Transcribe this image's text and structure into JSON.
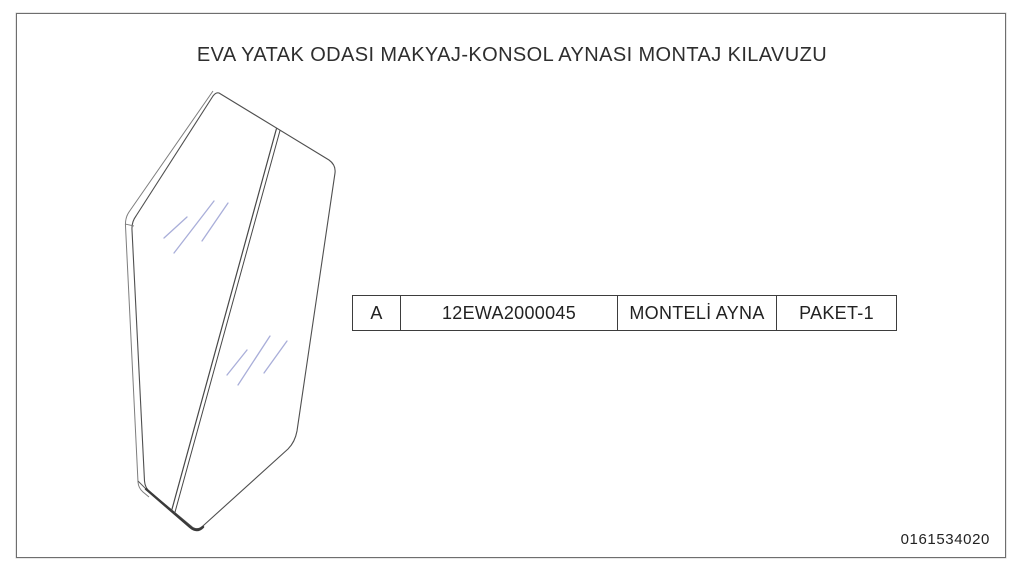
{
  "page": {
    "title": "EVA YATAK ODASI MAKYAJ-KONSOL AYNASI MONTAJ KILAVUZU",
    "doc_number": "0161534020"
  },
  "parts_table": {
    "rows": [
      {
        "item": "A",
        "part_no": "12EWA2000045",
        "description": "MONTELİ AYNA",
        "package": "PAKET-1"
      }
    ]
  },
  "drawing": {
    "name": "mounted-mirror-isometric-line-drawing",
    "line_color": "#4a4a4a",
    "edge_color": "#7d7d7d",
    "reflection_color": "#a9aed9"
  }
}
